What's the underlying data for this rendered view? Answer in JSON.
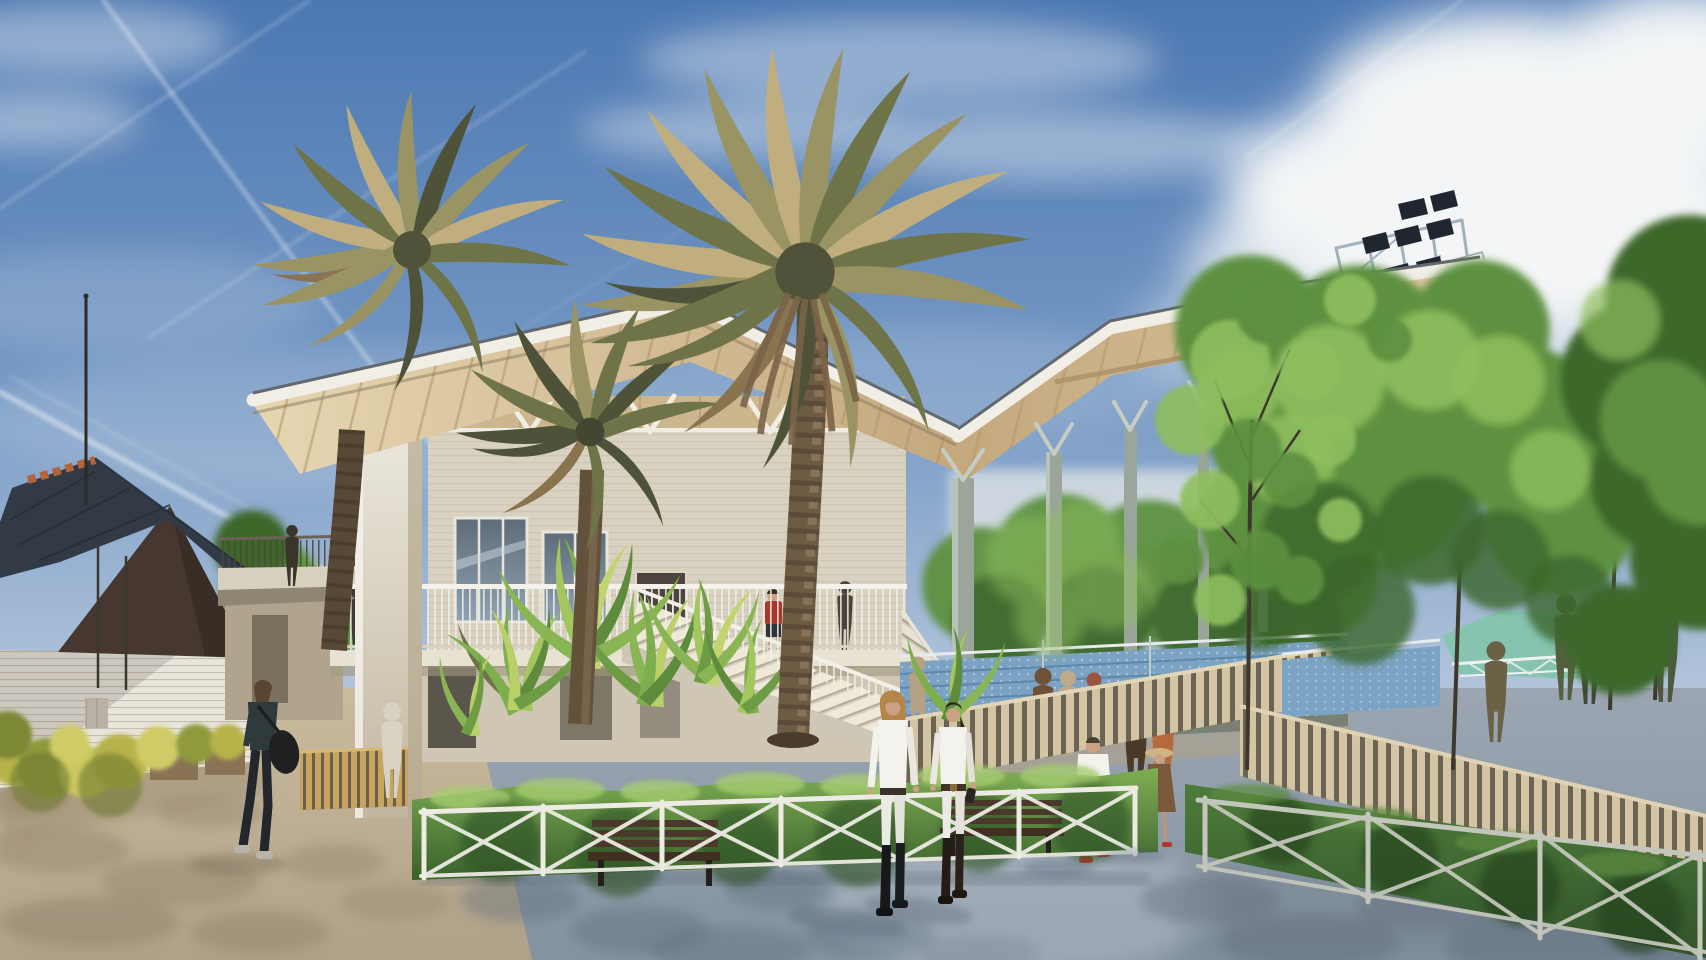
{
  "scene": {
    "type": "architectural-rendering",
    "title": "Equestrian club pavilion rendering — timber grandstand canopy, palm trees and plaza on a sunny day",
    "weather": "sunny, blue sky with cirrus clouds and jet contrails",
    "no_visible_text": true
  },
  "colors": {
    "sky_top": "#4c78b2",
    "sky_mid": "#7598c4",
    "sky_low": "#aabfd8",
    "sky_horizon": "#cdd7e3",
    "cloud": "#f3f5f6",
    "contrail": "#ffffff",
    "wood_soffit_light": "#e6d6b2",
    "wood_soffit_deep": "#c4a87e",
    "fascia": "#f1eee6",
    "roof_edge": "#62686e",
    "wall_cream": "#d9d2c1",
    "wall_lower": "#cfc6b4",
    "brick_line": "#cfc9bc",
    "pillar_light": "#efece4",
    "pillar_shade": "#c2b69e",
    "glass_top": "#5e6c78",
    "glass_bottom": "#90a2b2",
    "tile_roof": "#323a45",
    "gable_brown": "#463830",
    "terracotta": "#b4643c",
    "brick_white": "#e8e5dd",
    "palm_l1": "#c0ae7e",
    "palm_l2": "#9a9465",
    "palm_l3": "#6f7348",
    "palm_l4": "#4e5238",
    "palm_dead": "#8a7450",
    "trunk": "#6e5b44",
    "trunk_dark": "#4a3c2c",
    "trunk_light": "#8d775c",
    "tree_green_light": "#8fbe5e",
    "tree_green": "#5d9140",
    "tree_green_dark": "#3c672c",
    "dracaena": "#7fae4e",
    "dracaena_light": "#b9d06a",
    "hedge_light": "#7fae54",
    "hedge_dark": "#39602c",
    "hedge_right": "#31532a",
    "seat_blue": "#7ca3c3",
    "seat_blue_dark": "#5d87ab",
    "pave_light": "#9ba6b2",
    "pave_dark": "#8593a0",
    "pave_shadow": "#5c6a7a",
    "sand": "#cbbb9e",
    "sand_dark": "#b0a188",
    "sand_shadow": "#8b7c64",
    "fence_white": "#edebe3",
    "slat_tan": "#d3c4a3",
    "slat_gap": "#6b6353",
    "bench_wood": "#4a392b",
    "bench_dark": "#23201c",
    "teal_roof": "#84c4ae",
    "distant_building": "#cfc0ae",
    "steel": "#a2b2bd",
    "light_panel": "#1f2630",
    "column_grey": "#9aa59b",
    "skin": "#caa183",
    "white_cloth": "#f3f2ed",
    "red_shoes": "#c23a2c",
    "hat_tan": "#cdb484",
    "dress_brown": "#7a5a3a",
    "dark_cloth": "#2f3a3c",
    "red_top": "#a8372c",
    "orange_top": "#b5693c",
    "brown_shirt": "#6e5136"
  },
  "objects": [
    {
      "name": "left-building",
      "desc": "small clubhouse, dark slate tiled roof, terracotta ridge crest, dark brown gable, white painted brick walls, flagpole"
    },
    {
      "name": "main-pavilion",
      "desc": "two-storey cream brick clubhouse with upper terrace, glass doors, balustrade and grand staircase under a winged timber roof"
    },
    {
      "name": "grandstand-canopy",
      "desc": "cantilevered timber wing roof on slender steel columns over blue bleacher seating"
    },
    {
      "name": "floodlight-tower",
      "desc": "steel rack with two rows of dark stadium floodlight panels above the canopy"
    },
    {
      "name": "palm-trees",
      "desc": "three mature date palms, khaki-olive fronds, one large crown centre frame"
    },
    {
      "name": "dracaena-planter",
      "desc": "spiky green dracaena shrubs and low hedge in central planter"
    },
    {
      "name": "plaza",
      "desc": "blue-grey paved esplanade with dappled tree shadows, sandy path at left"
    },
    {
      "name": "fences",
      "desc": "white X-braced metal fences around planters, vertical timber-slat ramp railings"
    },
    {
      "name": "benches",
      "desc": "two dark timber benches behind the planter fence"
    },
    {
      "name": "background",
      "desc": "green trees, teal kiosk roof with white truss, distant terracotta city blocks, contrails in blue sky"
    }
  ],
  "people": [
    {
      "name": "rider-woman-blonde",
      "where": "foreground centre",
      "desc": "blonde woman walking, white shirt, white breeches, black riding boots, dark belt"
    },
    {
      "name": "rider-woman-dark",
      "where": "foreground centre",
      "desc": "dark-haired woman walking, white polo, white breeches, dark boots, holding gloves"
    },
    {
      "name": "man-white-shirt",
      "where": "mid-ground ramp",
      "desc": "man walking away, white shirt, grey shorts, red shoes"
    },
    {
      "name": "woman-sun-hat",
      "where": "mid-ground ramp",
      "desc": "woman in tan sun hat, brown dress, shoulder bag, red flats"
    },
    {
      "name": "woman-dark-bag",
      "where": "left foreground",
      "desc": "woman in dark top and leggings carrying a large black bag"
    },
    {
      "name": "person-red-top",
      "where": "upper terrace",
      "desc": "person in red top standing at the balustrade"
    },
    {
      "name": "couple-under-canopy",
      "where": "concourse",
      "desc": "man in brown shirt talking with auburn-haired woman in orange top"
    },
    {
      "name": "bystanders-concourse",
      "where": "concourse near bleachers",
      "desc": "several small figures strolling"
    },
    {
      "name": "figure-on-bridge",
      "where": "left walkway bridge",
      "desc": "dark silhouette standing at the rail"
    },
    {
      "name": "spectators-right-rail",
      "where": "right timber railing",
      "desc": "silhouettes leaning on the railing among trees"
    }
  ]
}
